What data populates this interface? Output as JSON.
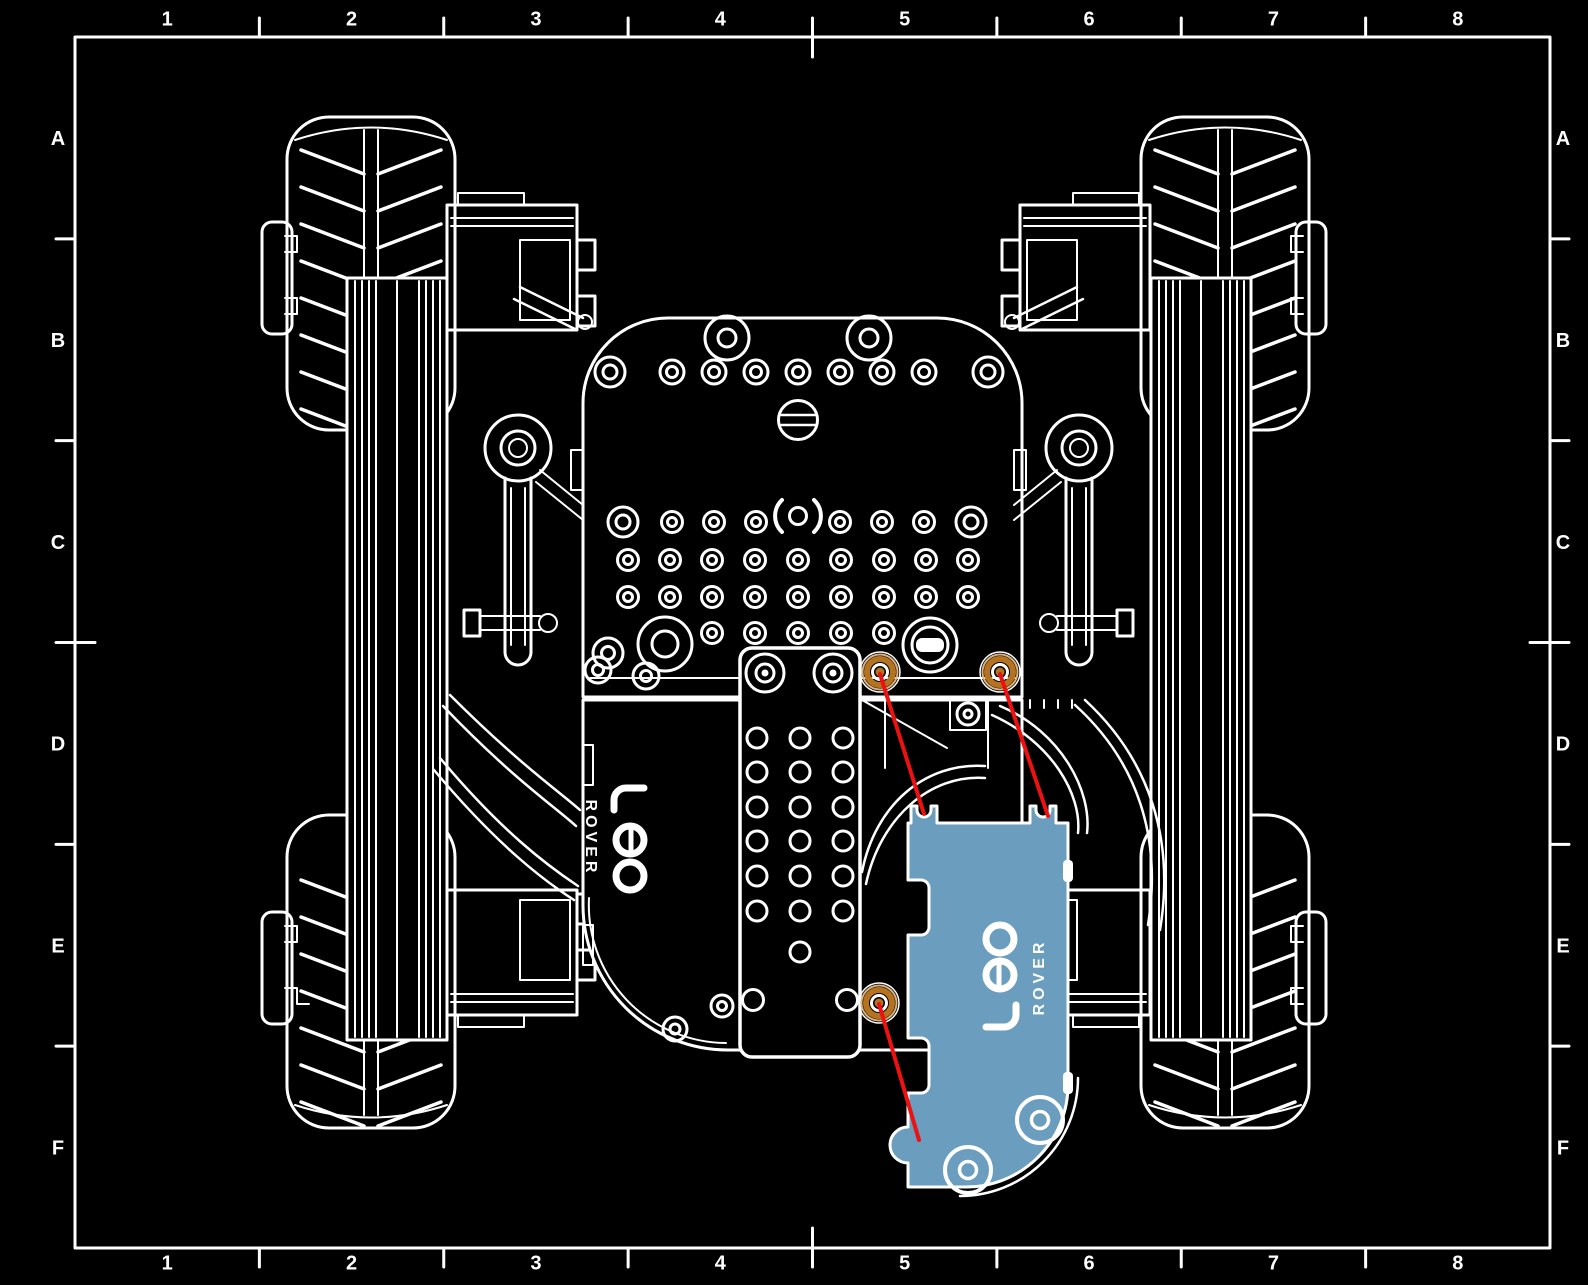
{
  "frame": {
    "column_labels": [
      "1",
      "2",
      "3",
      "4",
      "5",
      "6",
      "7",
      "8"
    ],
    "row_labels": [
      "A",
      "B",
      "C",
      "D",
      "E",
      "F"
    ]
  },
  "logo": {
    "word": "Leo",
    "subword": "ROVER"
  },
  "annotation": {
    "fastener_count": 3,
    "leader_line_count": 3,
    "highlighted_part": "rear cover plate"
  },
  "colors": {
    "background": "#000000",
    "line": "#ffffff",
    "highlight_part": "#6a9dbe",
    "fastener": "#b5731f",
    "fastener_halo": "#d9b183",
    "leader": "#ed1111"
  }
}
